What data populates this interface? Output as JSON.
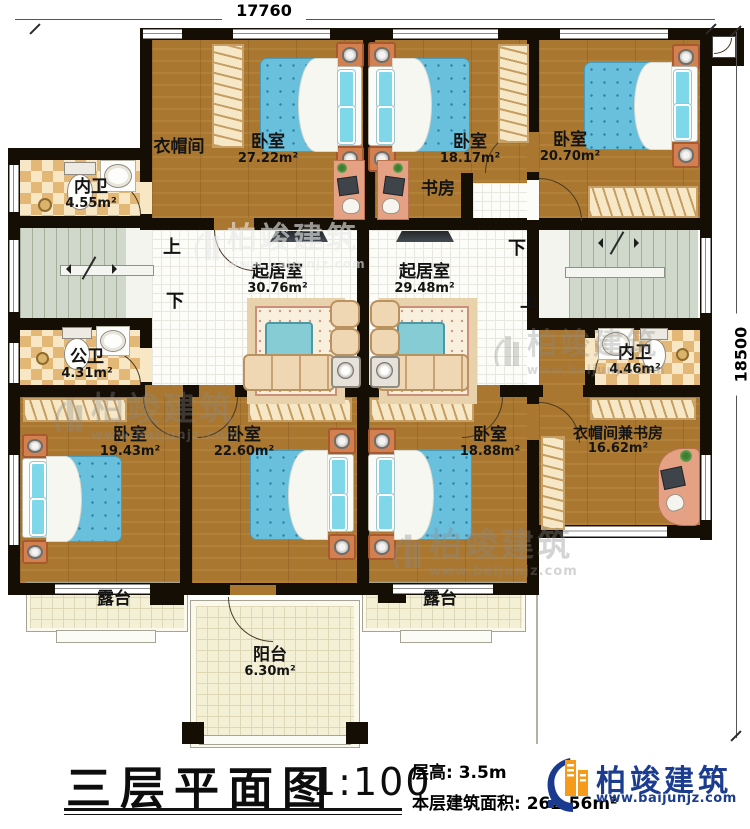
{
  "dimensions": {
    "top": "17760",
    "right": "18500"
  },
  "stairs": {
    "up": "上",
    "down": "下"
  },
  "rooms": {
    "cloakroom_tl": {
      "name": "衣帽间",
      "area": ""
    },
    "bedroom_tl": {
      "name": "卧室",
      "area": "27.22m²"
    },
    "bedroom_tm": {
      "name": "卧室",
      "area": "18.17m²"
    },
    "bedroom_tr": {
      "name": "卧室",
      "area": "20.70m²"
    },
    "bath_tl": {
      "name": "内卫",
      "area": "4.55m²"
    },
    "study_top": {
      "name": "书房",
      "area": ""
    },
    "living_left": {
      "name": "起居室",
      "area": "30.76m²"
    },
    "living_right": {
      "name": "起居室",
      "area": "29.48m²"
    },
    "bath_ml": {
      "name": "公卫",
      "area": "4.31m²"
    },
    "bath_mr": {
      "name": "内卫",
      "area": "4.46m²"
    },
    "bedroom_bl": {
      "name": "卧室",
      "area": "19.43m²"
    },
    "bedroom_bm": {
      "name": "卧室",
      "area": "22.60m²"
    },
    "bedroom_br": {
      "name": "卧室",
      "area": "18.88m²"
    },
    "cloak_study": {
      "name": "衣帽间兼书房",
      "area": "16.62m²"
    },
    "terrace_left": {
      "name": "露台",
      "area": ""
    },
    "balcony": {
      "name": "阳台",
      "area": "6.30m²"
    },
    "terrace_right": {
      "name": "露台",
      "area": ""
    }
  },
  "title": {
    "main": "三层平面图",
    "scale": "1:100"
  },
  "info": {
    "floor_height": "层高: 3.5m",
    "floor_area": "本层建筑面积: 262.56m²"
  },
  "brand": {
    "name": "柏竣建筑",
    "url": "www.baijunjz.com"
  },
  "watermark": {
    "name": "柏竣建筑",
    "url": "www.baijunjz.com"
  },
  "colors": {
    "brand_navy": "#1b3c8f",
    "brand_orange": "#f59a1a",
    "wall": "#150e04",
    "bed_blue": "#69c0dd"
  }
}
